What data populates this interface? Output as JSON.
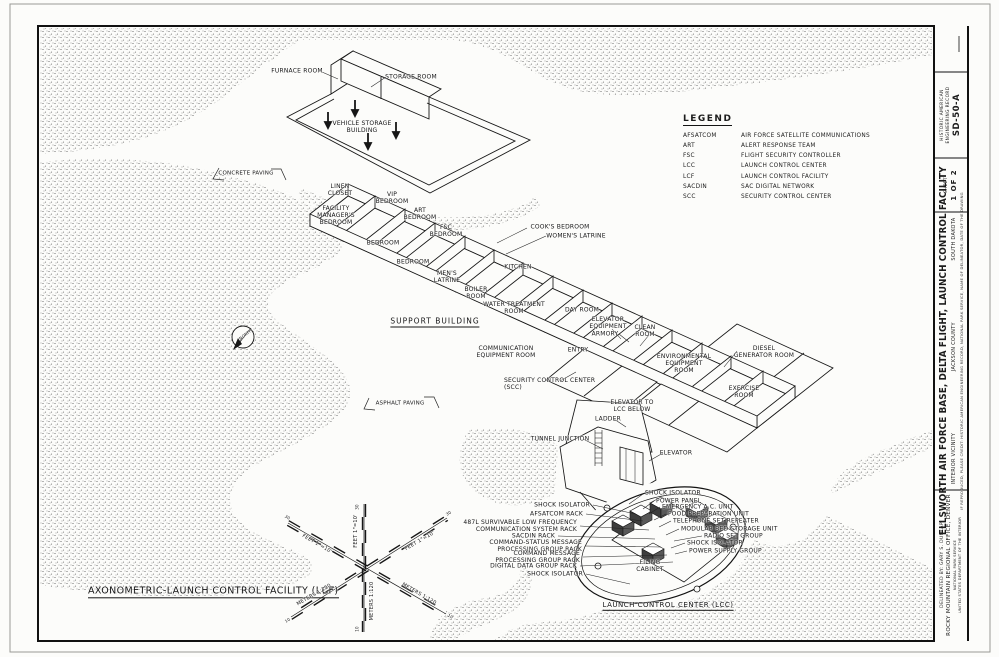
{
  "legend": {
    "title": "LEGEND",
    "items": [
      {
        "abbr": "AFSATCOM",
        "meaning": "AIR FORCE SATELLITE COMMUNICATIONS"
      },
      {
        "abbr": "ART",
        "meaning": "ALERT RESPONSE TEAM"
      },
      {
        "abbr": "FSC",
        "meaning": "FLIGHT SECURITY CONTROLLER"
      },
      {
        "abbr": "LCC",
        "meaning": "LAUNCH CONTROL CENTER"
      },
      {
        "abbr": "LCF",
        "meaning": "LAUNCH CONTROL FACILITY"
      },
      {
        "abbr": "SACDIN",
        "meaning": "SAC DIGITAL NETWORK"
      },
      {
        "abbr": "SCC",
        "meaning": "SECURITY CONTROL CENTER"
      }
    ]
  },
  "title_block": {
    "record_org_1": "HISTORIC AMERICAN",
    "record_org_2": "ENGINEERING RECORD",
    "record_no": "SD-50-A",
    "sheet_word": "SHEET",
    "sheet_no": "1 OF 2",
    "title": "ELLSWORTH AIR FORCE BASE, DELTA FLIGHT, LAUNCH CONTROL FACILITY",
    "vicinity": "INTERIOR VICINITY",
    "county": "JACKSON COUNTY",
    "state": "SOUTH DAKOTA",
    "credit": "IF REPRODUCED, PLEASE CREDIT: HISTORIC AMERICAN ENGINEERING RECORD, NATIONAL PARK SERVICE, NAME OF DELINEATOR, DATE OF THE DRAWING",
    "delineated": "DELINEATED BY:  GARY S. DUNLAP",
    "office": "ROCKY MOUNTAIN REGIONAL OFFICE, DENVER",
    "agency_1": "NATIONAL PARK SERVICE",
    "agency_2": "UNITED STATES DEPARTMENT OF THE INTERIOR"
  },
  "scale": {
    "feet_label": "FEET 1\"=10'",
    "meters_label": "METERS 1:120",
    "feet_ticks": [
      5,
      10,
      20,
      30
    ],
    "meters_ticks": [
      5,
      10
    ]
  },
  "labels": [
    {
      "t": "FURNACE ROOM",
      "x": 297,
      "y": 71,
      "n": "label-furnace-room"
    },
    {
      "t": "STORAGE ROOM",
      "x": 411,
      "y": 77,
      "n": "label-storage-room"
    },
    {
      "t": "VEHICLE STORAGE\nBUILDING",
      "x": 362,
      "y": 127,
      "n": "label-vehicle-storage-building"
    },
    {
      "t": "CONCRETE PAVING",
      "x": 246,
      "y": 174,
      "s": 5.5,
      "n": "label-concrete-paving"
    },
    {
      "t": "ASPHALT PAVING",
      "x": 400,
      "y": 404,
      "s": 5.5,
      "n": "label-asphalt-paving"
    },
    {
      "t": "NORTH",
      "x": 246,
      "y": 335,
      "s": 4,
      "r": -38,
      "n": "label-north"
    },
    {
      "t": "SUPPORT BUILDING",
      "x": 435,
      "y": 322,
      "s": 7.5,
      "u": 1,
      "ls": 1,
      "n": "label-support-building"
    },
    {
      "t": "LINEN\nCLOSET",
      "x": 340,
      "y": 190
    },
    {
      "t": "VIP\nBEDROOM",
      "x": 392,
      "y": 198
    },
    {
      "t": "FACILITY\nMANAGER'S\nBEDROOM",
      "x": 336,
      "y": 216
    },
    {
      "t": "ART\nBEDROOM",
      "x": 420,
      "y": 214
    },
    {
      "t": "FSC\nBEDROOM",
      "x": 446,
      "y": 231
    },
    {
      "t": "BEDROOM",
      "x": 383,
      "y": 243
    },
    {
      "t": "BEDROOM",
      "x": 413,
      "y": 262
    },
    {
      "t": "COOK'S BEDROOM",
      "x": 560,
      "y": 227
    },
    {
      "t": "WOMEN'S LATRINE",
      "x": 576,
      "y": 236
    },
    {
      "t": "KITCHEN",
      "x": 518,
      "y": 267
    },
    {
      "t": "MEN'S\nLATRINE",
      "x": 447,
      "y": 277
    },
    {
      "t": "BOILER\nROOM",
      "x": 476,
      "y": 293
    },
    {
      "t": "WATER TREATMENT\nROOM",
      "x": 514,
      "y": 308
    },
    {
      "t": "DAY ROOM",
      "x": 582,
      "y": 310
    },
    {
      "t": "ELEVATOR\nEQUIPMENT",
      "x": 608,
      "y": 323
    },
    {
      "t": "ARMORY",
      "x": 605,
      "y": 334
    },
    {
      "t": "CLEAN\nROOM",
      "x": 645,
      "y": 331
    },
    {
      "t": "ENTRY",
      "x": 578,
      "y": 350
    },
    {
      "t": "COMMUNICATION\nEQUIPMENT ROOM",
      "x": 506,
      "y": 352
    },
    {
      "t": "ENVIRONMENTAL\nEQUIPMENT\nROOM",
      "x": 684,
      "y": 364
    },
    {
      "t": "DIESEL\nGENERATOR ROOM",
      "x": 764,
      "y": 352
    },
    {
      "t": "EXERCISE\nROOM",
      "x": 744,
      "y": 392
    },
    {
      "t": "SECURITY CONTROL CENTER\n(SCC)",
      "x": 504,
      "y": 384,
      "a": "l"
    },
    {
      "t": "ELEVATOR TO\nLCC BELOW",
      "x": 632,
      "y": 406
    },
    {
      "t": "LADDER",
      "x": 608,
      "y": 419
    },
    {
      "t": "TUNNEL JUNCTION",
      "x": 560,
      "y": 439
    },
    {
      "t": "ELEVATOR",
      "x": 676,
      "y": 453
    },
    {
      "t": "SHOCK ISOLATOR",
      "x": 590,
      "y": 505,
      "a": "r"
    },
    {
      "t": "AFSATCOM RACK",
      "x": 583,
      "y": 514,
      "a": "r"
    },
    {
      "t": "487L SURVIVABLE LOW FREQUENCY\nCOMMUNICATION SYSTEM RACK",
      "x": 577,
      "y": 526,
      "a": "r"
    },
    {
      "t": "SACDIN RACK",
      "x": 555,
      "y": 536,
      "a": "r"
    },
    {
      "t": "COMMAND-STATUS MESSAGE\nPROCESSING GROUP RACK",
      "x": 582,
      "y": 546,
      "a": "r"
    },
    {
      "t": "COMMAND MESSAGE\nPROCESSING GROUP RACK",
      "x": 580,
      "y": 557,
      "a": "r"
    },
    {
      "t": "DIGITAL DATA GROUP RACK",
      "x": 577,
      "y": 566,
      "a": "r"
    },
    {
      "t": "SHOCK ISOLATOR",
      "x": 583,
      "y": 574,
      "a": "r"
    },
    {
      "t": "SHOCK ISOLATOR",
      "x": 645,
      "y": 493,
      "a": "l"
    },
    {
      "t": "POWER PANEL",
      "x": 656,
      "y": 501,
      "a": "l"
    },
    {
      "t": "EMERGENCY A.C. UNIT",
      "x": 662,
      "y": 507,
      "a": "l"
    },
    {
      "t": "FOOD PREPARATION UNIT",
      "x": 668,
      "y": 514,
      "a": "l"
    },
    {
      "t": "TELEPHONE SET REPEATER",
      "x": 673,
      "y": 521,
      "a": "l"
    },
    {
      "t": "MODULAR BED STORAGE UNIT",
      "x": 681,
      "y": 529,
      "a": "l"
    },
    {
      "t": "RADIO SET GROUP",
      "x": 704,
      "y": 536,
      "a": "l"
    },
    {
      "t": "SHOCK ISOLATOR",
      "x": 687,
      "y": 543,
      "a": "l"
    },
    {
      "t": "POWER SUPPLY GROUP",
      "x": 689,
      "y": 551,
      "a": "l"
    },
    {
      "t": "FILING\nCABINET",
      "x": 650,
      "y": 566
    },
    {
      "t": "LAUNCH CONTROL CENTER (LCC)",
      "x": 668,
      "y": 606,
      "s": 7,
      "u": 1,
      "ls": 0.5,
      "n": "label-launch-control-center"
    },
    {
      "t": "AXONOMETRIC-LAUNCH CONTROL FACILITY (LCF)",
      "x": 88,
      "y": 592,
      "s": 9.5,
      "u": 1,
      "a": "l",
      "ls": 0.4,
      "n": "drawing-title"
    },
    {
      "t": "FEET 1\"=10'",
      "x": 317,
      "y": 544,
      "s": 5,
      "r": 30
    },
    {
      "t": "FEET 1\"=10'",
      "x": 356,
      "y": 531,
      "s": 5,
      "r": -90
    },
    {
      "t": "FEET 1\"=10'",
      "x": 420,
      "y": 541,
      "s": 5,
      "r": -30
    },
    {
      "t": "METERS 1:120",
      "x": 314,
      "y": 595,
      "s": 5,
      "r": -30
    },
    {
      "t": "METERS 1:120",
      "x": 372,
      "y": 601,
      "s": 5,
      "r": -90
    },
    {
      "t": "METERS 1:120",
      "x": 419,
      "y": 594,
      "s": 5,
      "r": 30
    },
    {
      "t": "30",
      "x": 287,
      "y": 518,
      "s": 4,
      "r": 30
    },
    {
      "t": "30",
      "x": 449,
      "y": 514,
      "s": 4,
      "r": -30
    },
    {
      "t": "30",
      "x": 358,
      "y": 507,
      "s": 4,
      "r": -90
    },
    {
      "t": "10",
      "x": 288,
      "y": 621,
      "s": 4,
      "r": -30
    },
    {
      "t": "10",
      "x": 450,
      "y": 617,
      "s": 4,
      "r": 30
    },
    {
      "t": "10",
      "x": 358,
      "y": 629,
      "s": 4,
      "r": -90
    }
  ]
}
